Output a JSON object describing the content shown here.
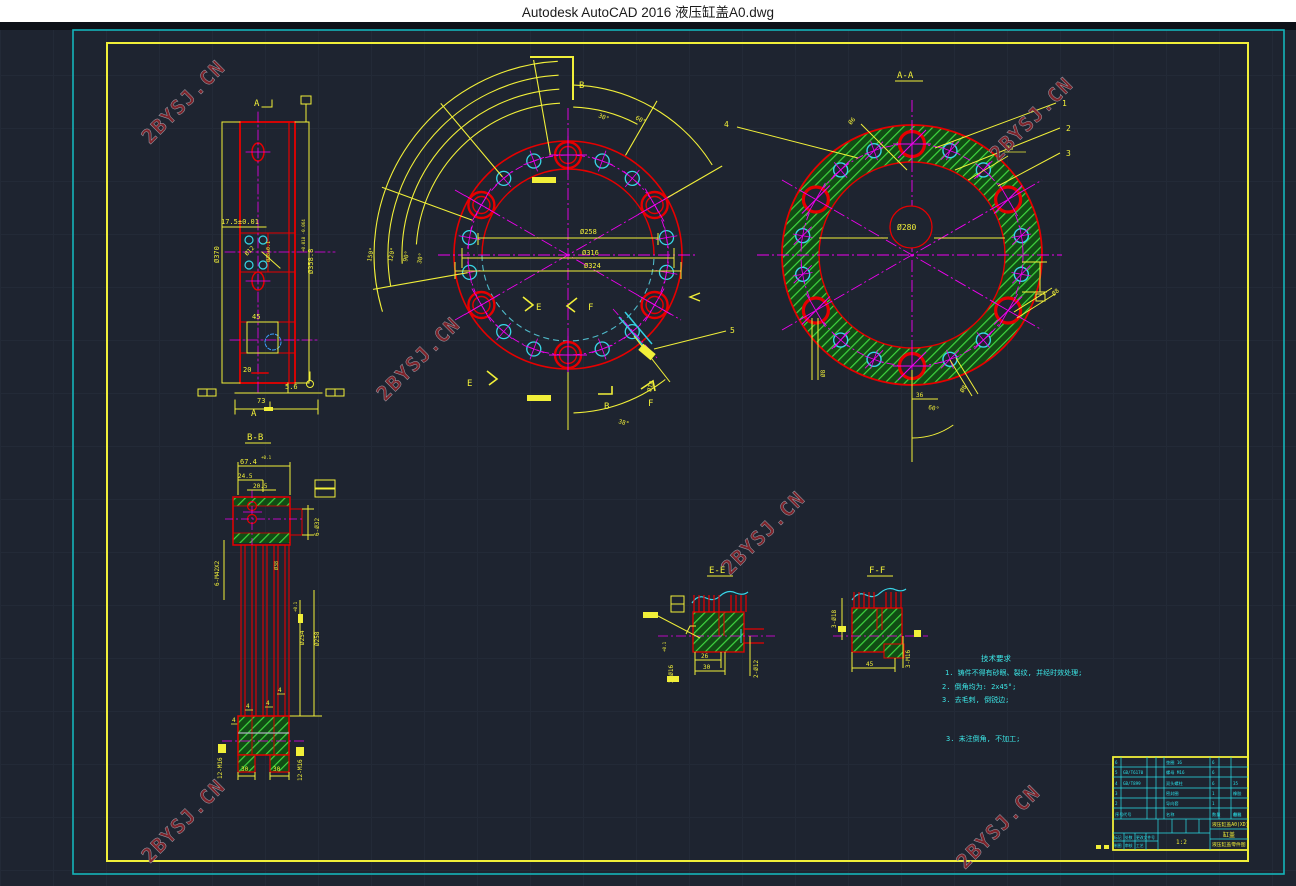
{
  "window": {
    "title": "Autodesk AutoCAD 2016    液压缸盖A0.dwg"
  },
  "watermark": {
    "text": "2BYSJ.CN"
  },
  "views": {
    "side": {
      "section": "A",
      "d370": "Ø370",
      "d17": "17.5±0.01",
      "d12": "Ø12",
      "d38": "Ø38±0.1",
      "d358": "Ø358.8",
      "tol358": "+0.018 -0.064",
      "n45": "45",
      "n20": "20",
      "n56": "5.6",
      "n73": "73"
    },
    "front": {
      "b": "B",
      "e": "E",
      "f": "F",
      "a150": "150°",
      "a120": "120°",
      "a90": "90°",
      "a30s": "30°",
      "a30": "30°",
      "a60": "60°",
      "d258": "Ø258",
      "d316": "Ø316",
      "d324": "Ø324",
      "d18": "Ø18",
      "a38": "38°",
      "n5": "5"
    },
    "aa": {
      "title": "A-A",
      "n1": "1",
      "n2": "2",
      "n3": "3",
      "n4": "4",
      "d280": "Ø280",
      "d8": "Ø8",
      "d6": "Ø6",
      "n36": "36",
      "a60": "60°"
    },
    "bb": {
      "title": "B-B",
      "d67": "67.4",
      "t67": "+0.1",
      "d245": "24.5",
      "d205": "20.5",
      "m42": "6-M42X2",
      "d32": "6-Ø32",
      "d38": "Ø38",
      "d254": "Ø254",
      "t254": "+0.1",
      "d258": "Ø258",
      "n4": "4",
      "n30": "30",
      "m16": "12-M16"
    },
    "ee": {
      "title": "E-E",
      "n26": "26",
      "n30": "30",
      "d12": "2-Ø12",
      "d16": "2-Ø16",
      "t16": "+0.1"
    },
    "ff": {
      "title": "F-F",
      "d18": "3-Ø18",
      "n45": "45",
      "m16": "3-M16"
    }
  },
  "notes": {
    "heading": "技术要求",
    "l1": "1. 铸件不得有砂眼、裂纹, 并经时效处理;",
    "l2": "2. 倒角均为: 2x45°;",
    "l3": "3. 去毛刺, 倒锐边;",
    "l4": "3. 未注倒角, 不加工;"
  },
  "title_block": {
    "code": "液压缸盖A0(XD)",
    "name": "缸盖",
    "doc": "液压缸盖零件图",
    "scale": "1:2",
    "parts": [
      {
        "no": "6",
        "code": "",
        "name": "垫圈 16",
        "qty": "6",
        "mat": ""
      },
      {
        "no": "5",
        "code": "GB/T6170",
        "name": "螺母 M16",
        "qty": "6",
        "mat": ""
      },
      {
        "no": "4",
        "code": "GB/T899",
        "name": "双头螺柱",
        "qty": "6",
        "mat": "35"
      },
      {
        "no": "3",
        "code": "",
        "name": "密封圈",
        "qty": "1",
        "mat": "橡胶"
      },
      {
        "no": "2",
        "code": "",
        "name": "导向套",
        "qty": "1",
        "mat": ""
      },
      {
        "no": "序号",
        "code": "代号",
        "name": "名称",
        "qty": "数量",
        "mat": "材料"
      }
    ],
    "remark_header": "备注",
    "sig_row1": [
      "标记",
      "处数",
      "更改文件号"
    ],
    "sig_row2": [
      "制图",
      "审核",
      "工艺"
    ]
  },
  "colors": {
    "background": "#1e2430",
    "frame_outer": "#14b4ba",
    "frame_inner": "#f1ef39",
    "line_yellow": "#f1ef39",
    "line_red": "#e60000",
    "line_magenta": "#f000f0",
    "line_cyan": "#38d6e6",
    "hatch_green": "#3fd63f",
    "notes_cyan": "#3ce6e6",
    "watermark_red": "#84242b",
    "titlebar_bg": "#ffffff"
  }
}
